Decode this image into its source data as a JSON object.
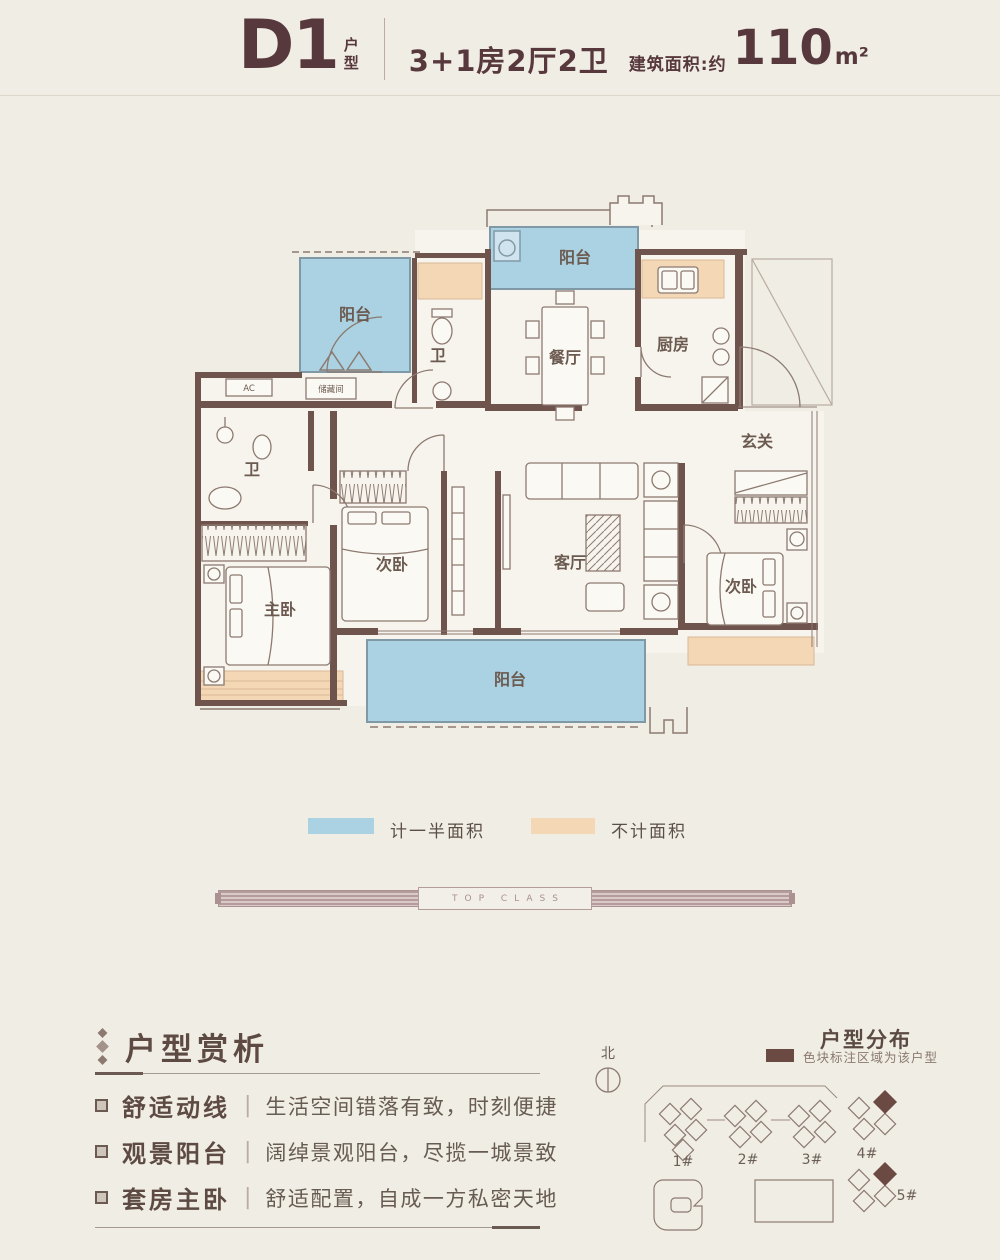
{
  "header": {
    "plan_code": "D1",
    "plan_code_suffix": "户型",
    "layout": "3+1房2厅2卫",
    "area_label": "建筑面积:约",
    "area_value": "110",
    "area_unit": "m²"
  },
  "floorplan": {
    "rooms": {
      "balcony_left": "阳台",
      "balcony_top": "阳台",
      "balcony_bottom": "阳台",
      "bath_upper": "卫",
      "bath_lower": "卫",
      "dining": "餐厅",
      "kitchen": "厨房",
      "entry": "玄关",
      "storage": "储藏间",
      "ac": "AC",
      "bedroom_mid": "次卧",
      "bedroom_right": "次卧",
      "bedroom_master": "主卧",
      "living": "客厅"
    },
    "colors": {
      "half_area": "#abd2e2",
      "not_counted": "#f4d7b5",
      "wall": "#6f534d",
      "accent": "#57383c",
      "highlight": "#6b4a44"
    }
  },
  "legend": {
    "half_area_label": "计一半面积",
    "not_counted_label": "不计面积"
  },
  "divider": {
    "label": "TOP CLASS"
  },
  "analysis": {
    "title": "户型赏析",
    "items": [
      {
        "term": "舒适动线",
        "desc": "生活空间错落有致，时刻便捷"
      },
      {
        "term": "观景阳台",
        "desc": "阔绰景观阳台，尽揽一城景致"
      },
      {
        "term": "套房主卧",
        "desc": "舒适配置，自成一方私密天地"
      }
    ]
  },
  "distribution": {
    "title": "户型分布",
    "legend_label": "色块标注区域为该户型",
    "compass_label": "北",
    "buildings": [
      {
        "label": "1#",
        "highlighted": false
      },
      {
        "label": "2#",
        "highlighted": false
      },
      {
        "label": "3#",
        "highlighted": false
      },
      {
        "label": "4#",
        "highlighted": true
      },
      {
        "label": "5#",
        "highlighted": true
      }
    ]
  }
}
